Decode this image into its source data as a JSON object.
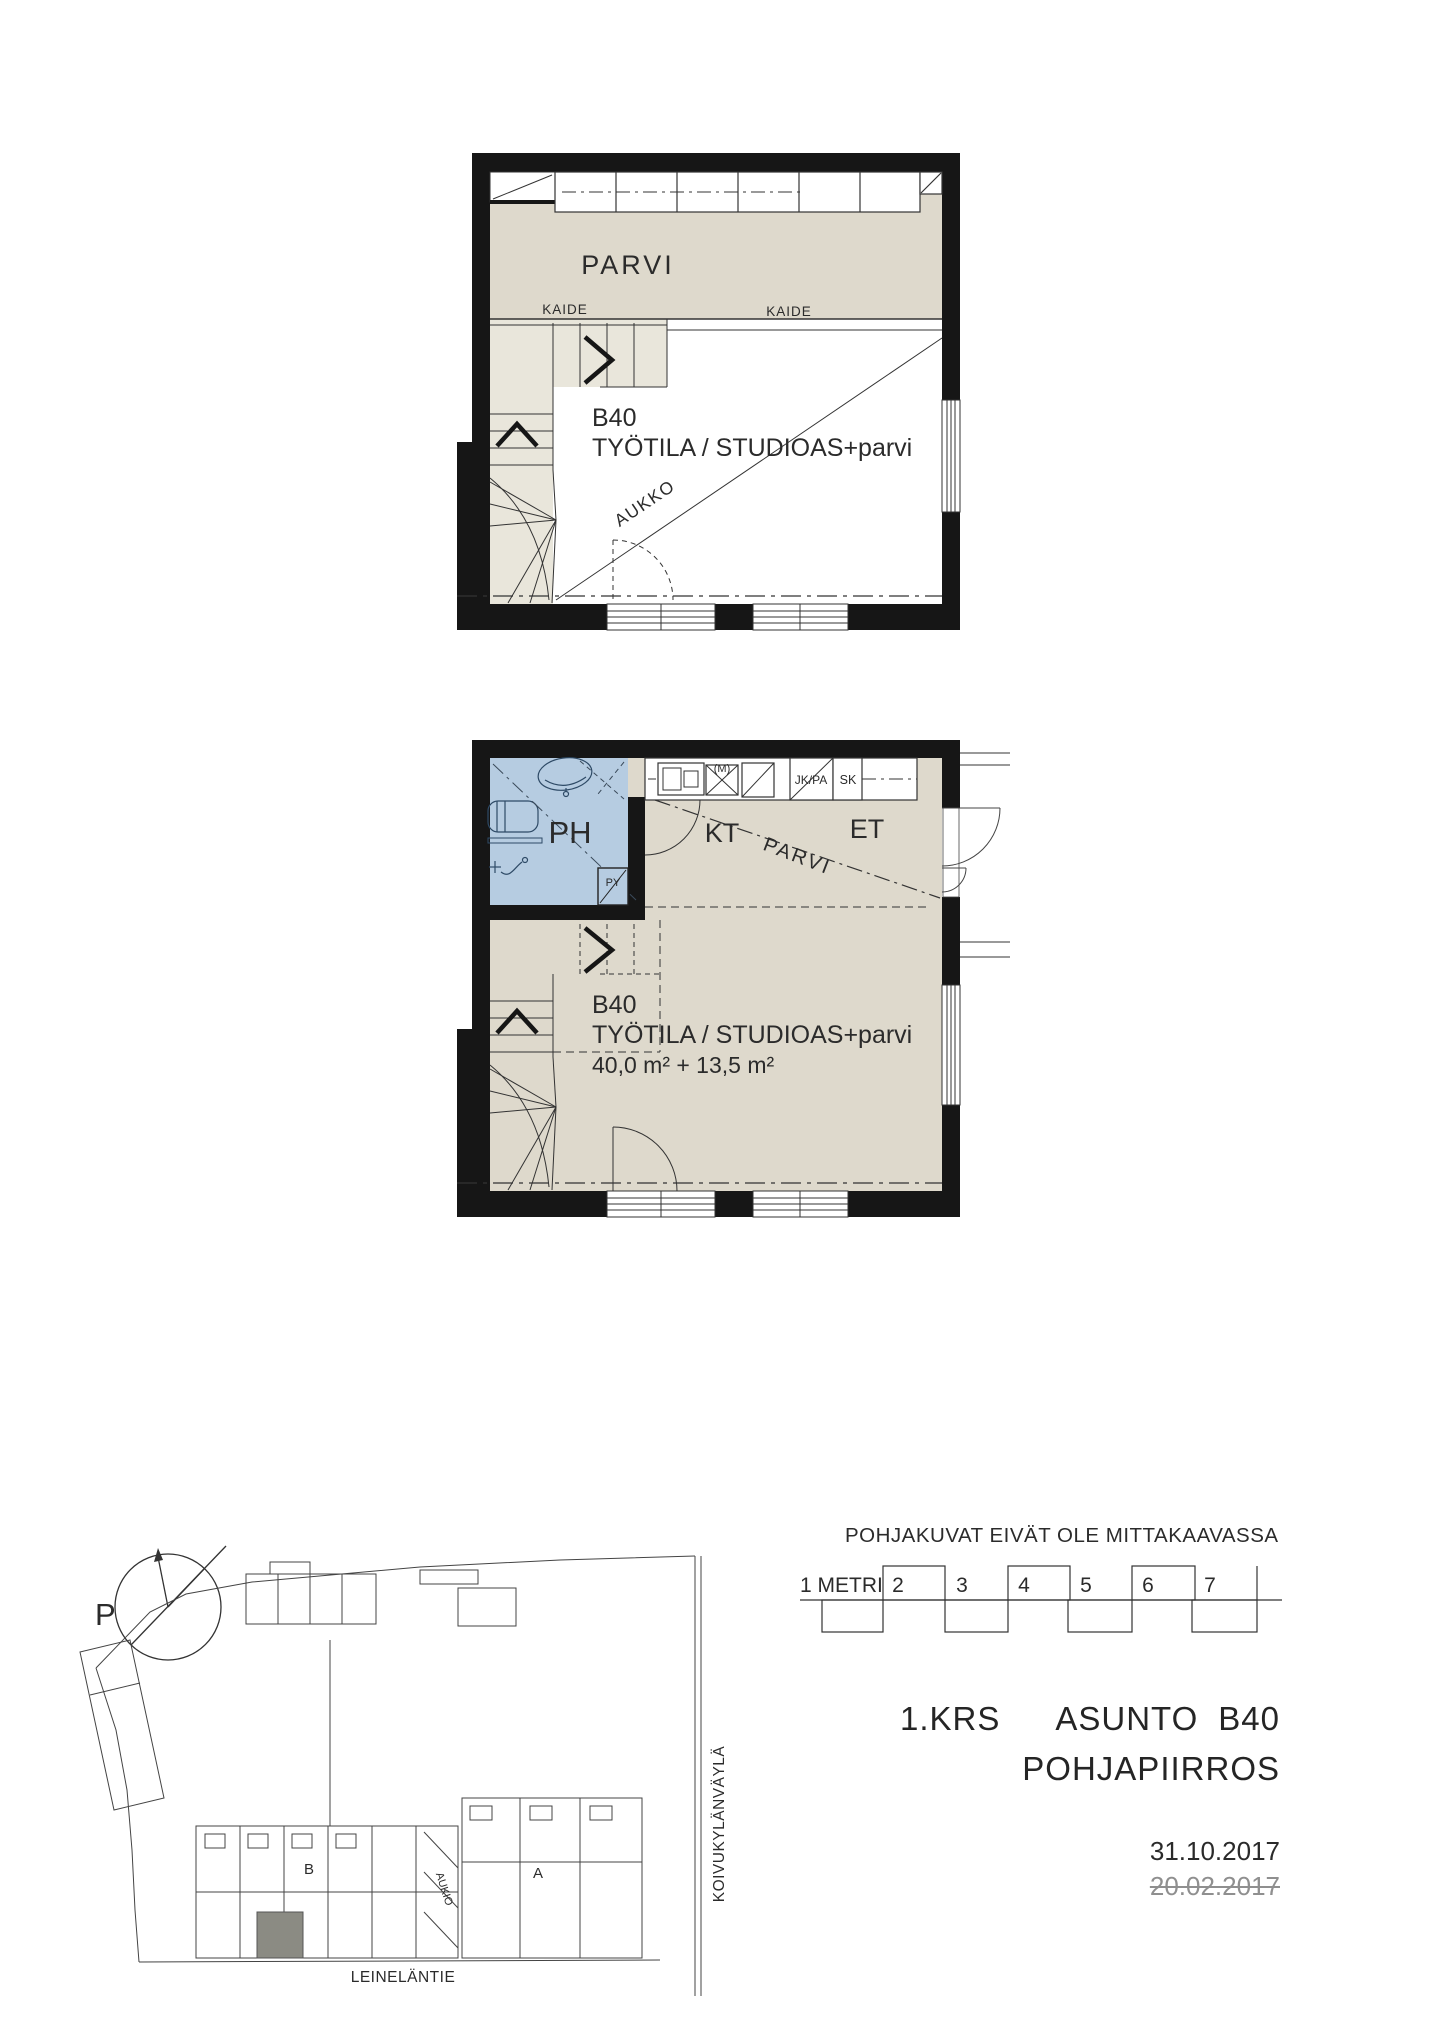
{
  "upper_plan": {
    "room": "PARVI",
    "railing_left": "KAIDE",
    "railing_right": "KAIDE",
    "unit": "B40",
    "unit_type": "TYÖTILA / STUDIOAS+parvi",
    "opening": "AUKKO"
  },
  "middle_plan": {
    "bathroom": "PH",
    "closet": "PY",
    "kitchen": "KT",
    "entry": "ET",
    "loft_above": "PARVI",
    "unit": "B40",
    "unit_type": "TYÖTILA / STUDIOAS+parvi",
    "area": "40,0 m² + 13,5 m²",
    "appliance_m": "(M)",
    "fridge_freezer": "JK/PA",
    "cabinet": "SK"
  },
  "note": "POHJAKUVAT EIVÄT OLE MITTAKAAVASSA",
  "scale_bar": {
    "first": "1 METRI",
    "n2": "2",
    "n3": "3",
    "n4": "4",
    "n5": "5",
    "n6": "6",
    "n7": "7"
  },
  "title": {
    "floor": "1.KRS",
    "apartment": "ASUNTO",
    "unit": "B40",
    "drawing": "POHJAPIIRROS",
    "date": "31.10.2017",
    "old_date": "20.02.2017"
  },
  "site": {
    "north": "P",
    "block_b": "B",
    "block_a": "A",
    "plaza": "AUKIO",
    "street_right": "KOIVUKYLÄNVÄYLÄ",
    "street_bottom": "LEINELÄNTIE"
  },
  "colors": {
    "wall": "#161616",
    "room_fill": "#ded9cc",
    "stair_fill": "#e9e6db",
    "bath_fill": "#b6cce1",
    "line": "#333333",
    "highlight_unit": "#8b8b83",
    "old_date_gray": "#8f8f8f"
  }
}
